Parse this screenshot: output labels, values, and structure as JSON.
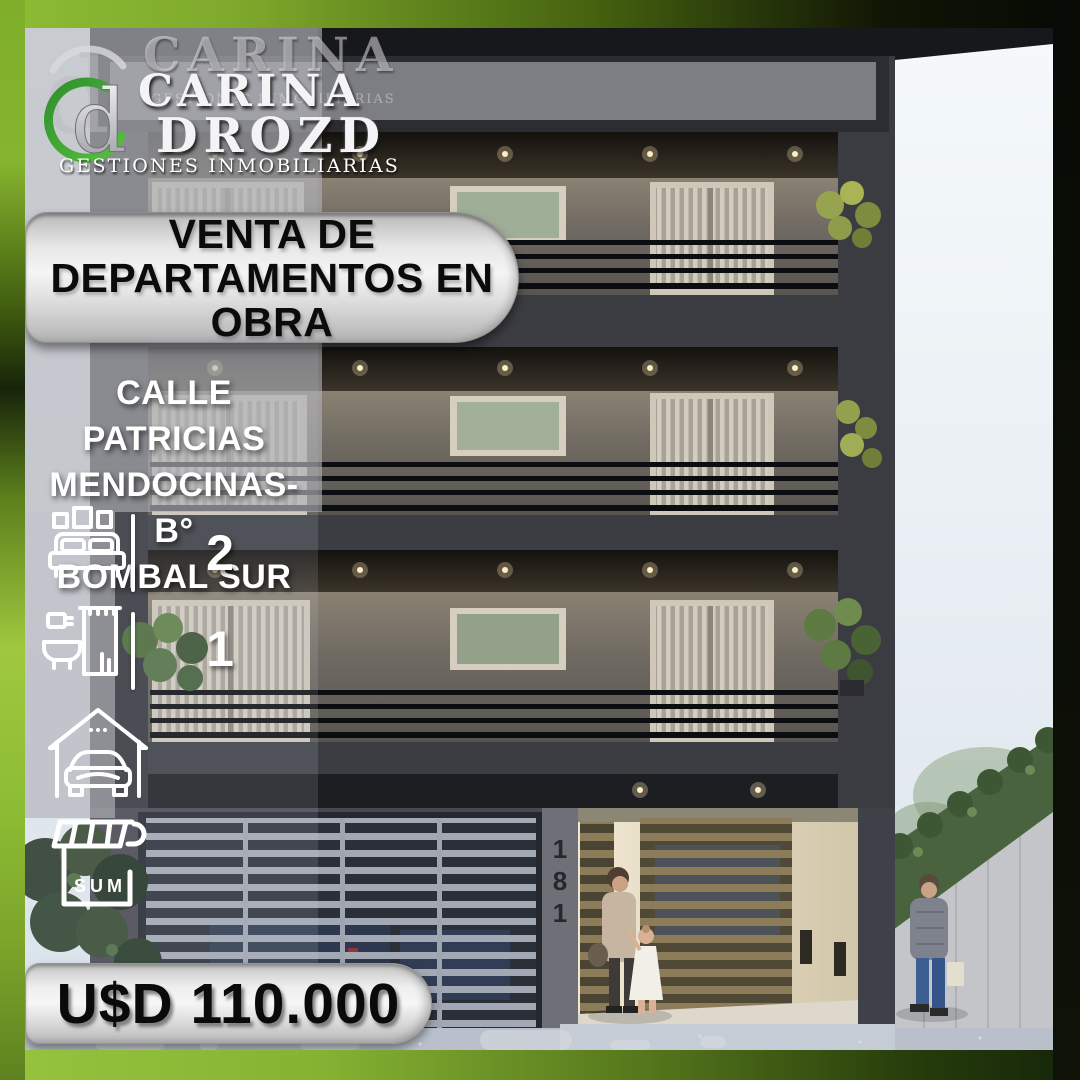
{
  "brand": {
    "monogram": "d",
    "ghost_name": "CARINA",
    "ghost_tagline": "GESTIONES INMOBILIARIAS",
    "name_line1": "CARINA",
    "name_line2": "DROZD",
    "tagline": "GESTIONES INMOBILIARIAS",
    "accent_green": "#46a043"
  },
  "banner": {
    "line1": "VENTA DE",
    "line2": "DEPARTAMENTOS EN",
    "line3": "OBRA"
  },
  "location": {
    "line1": "CALLE PATRICIAS",
    "line2": "MENDOCINAS- B°",
    "line3": "BOMBAL SUR"
  },
  "features": {
    "bedrooms": "2",
    "bathrooms": "1",
    "sum_label": "SUM",
    "icons": [
      "bedroom-icon",
      "bathroom-icon",
      "garage-icon",
      "sum-icon"
    ]
  },
  "price": "U$D 110.000",
  "building": {
    "number_digit_1": "1",
    "number_digit_2": "8",
    "number_digit_3": "1"
  },
  "palette": {
    "frame_green": "#8dbc34",
    "frame_green_dark": "#1c2a0c",
    "frame_black": "#0a0b07",
    "pill_silver": "#e9e9e9",
    "facade_gray": "#45464c",
    "sky": "#eef3f7",
    "text_black": "#0b0b0b",
    "text_white": "#ffffff"
  }
}
